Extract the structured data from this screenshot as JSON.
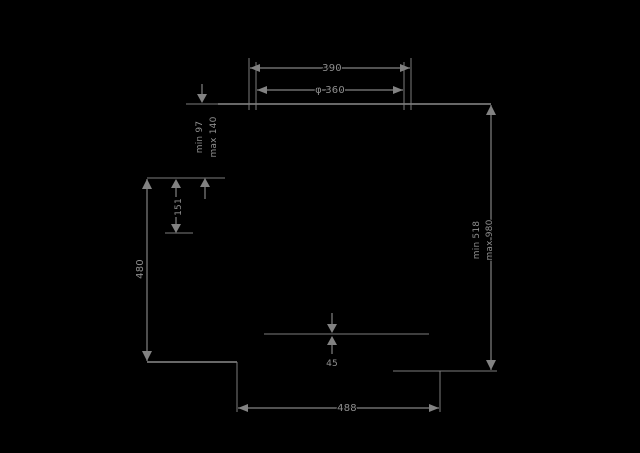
{
  "drawing": {
    "title": "appliance-dimension-diagram",
    "background_color": "#000000",
    "line_color": "#828282",
    "text_color": "#8f8f8f",
    "labels": {
      "top_width": "390",
      "top_diameter": "φ 360",
      "upper_left_min": "min 97",
      "upper_left_max": "max 140",
      "left_small_height": "151",
      "left_height": "480",
      "right_min": "min 518",
      "right_max": "max 980",
      "bottom_width": "488",
      "center_gap": "45"
    }
  }
}
